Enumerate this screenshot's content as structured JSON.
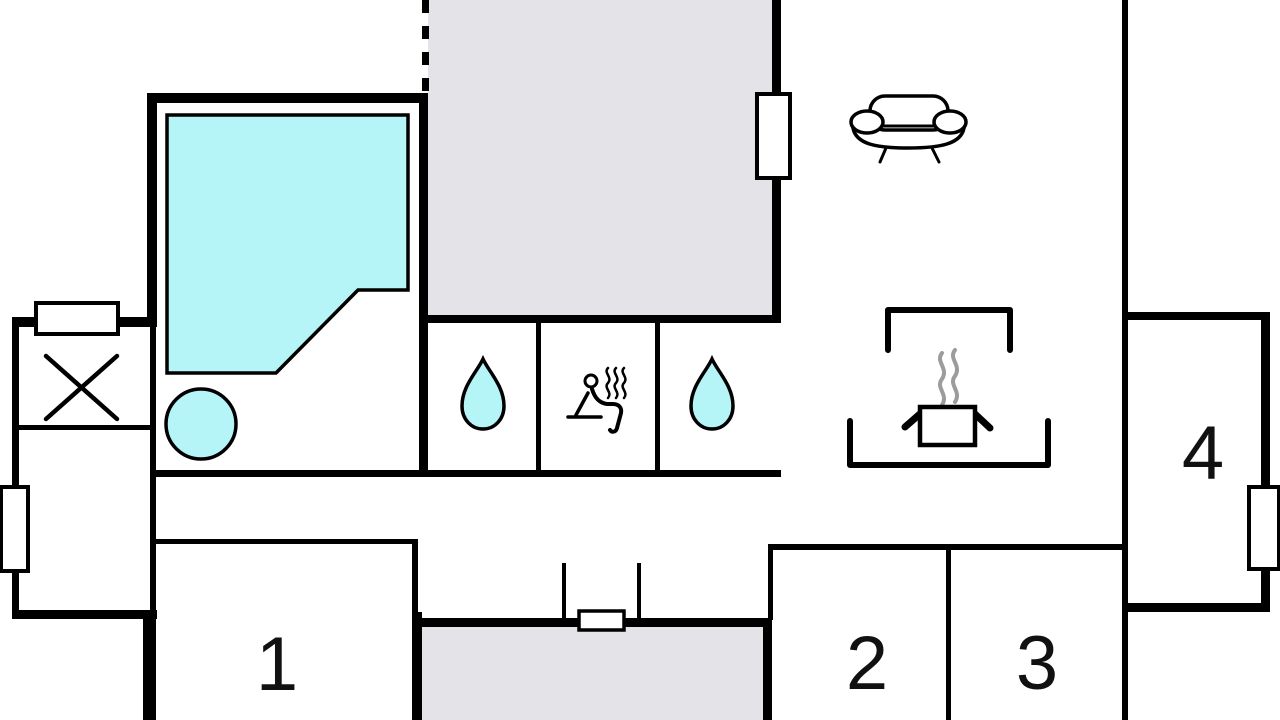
{
  "rooms": [
    {
      "name": "room-1",
      "label": "1"
    },
    {
      "name": "room-2",
      "label": "2"
    },
    {
      "name": "room-3",
      "label": "3"
    },
    {
      "name": "room-4",
      "label": "4"
    }
  ],
  "icons": {
    "pool": "swimming-pool",
    "whirlpool": "whirlpool-tub",
    "shower_left": "water-drop",
    "sauna": "sauna-person-with-steam",
    "shower_right": "water-drop",
    "sofa": "sofa",
    "stove": "steaming-pot-kitchen",
    "technical": "crossed-box",
    "entrance": "door-opening",
    "window": "window-opening"
  },
  "colors": {
    "water": "#b5f4f7",
    "floor_gray": "#e4e4e8",
    "wall": "#000000",
    "steam_gray": "#9c9c9c",
    "background": "#ffffff",
    "label": "#111111"
  }
}
